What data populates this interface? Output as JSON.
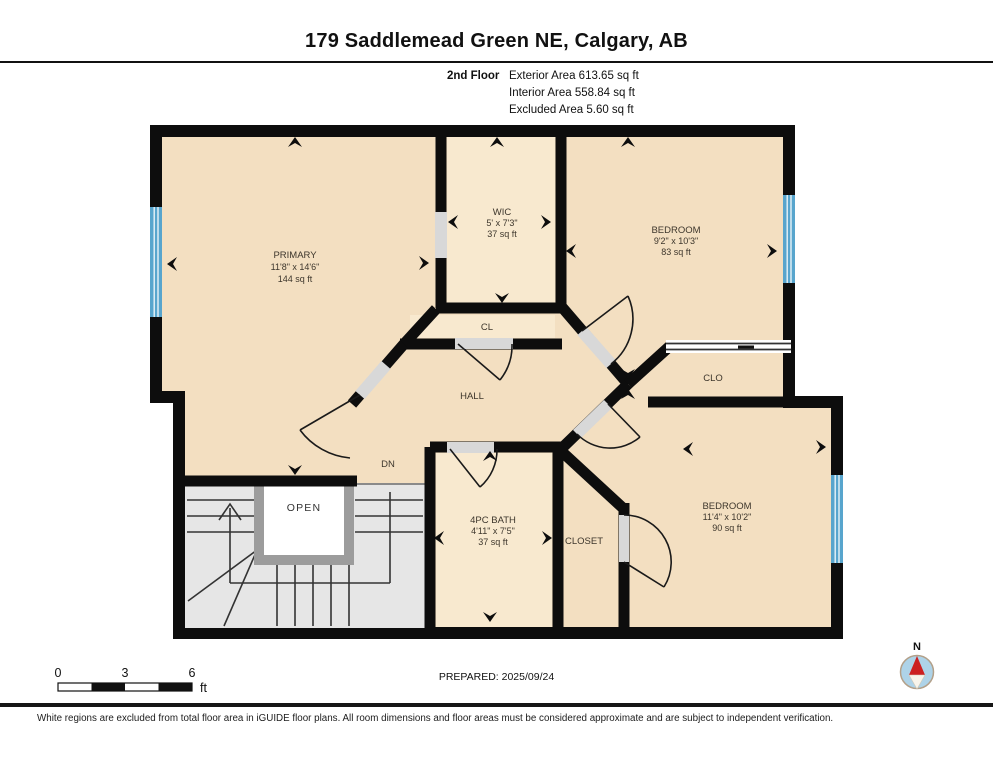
{
  "title": "179 Saddlemead Green NE, Calgary, AB",
  "floor_info": {
    "floor": "2nd Floor",
    "exterior": "Exterior Area 613.65 sq ft",
    "interior": "Interior Area 558.84 sq ft",
    "excluded": "Excluded Area 5.60 sq ft"
  },
  "rooms": {
    "primary": {
      "name": "PRIMARY",
      "dims": "11'8\" x 14'6\"",
      "area": "144 sq ft"
    },
    "wic": {
      "name": "WIC",
      "dims": "5' x 7'3\"",
      "area": "37 sq ft"
    },
    "bedroom1": {
      "name": "BEDROOM",
      "dims": "9'2\" x 10'3\"",
      "area": "83 sq ft"
    },
    "bedroom2": {
      "name": "BEDROOM",
      "dims": "11'4\" x 10'2\"",
      "area": "90 sq ft"
    },
    "bath": {
      "name": "4PC BATH",
      "dims": "4'11\" x 7'5\"",
      "area": "37 sq ft"
    },
    "hall": {
      "name": "HALL"
    },
    "cl": {
      "name": "CL"
    },
    "clo": {
      "name": "CLO"
    },
    "closet": {
      "name": "CLOSET"
    },
    "open": {
      "name": "OPEN"
    },
    "dn": {
      "name": "DN"
    }
  },
  "scale": {
    "t0": "0",
    "t3": "3",
    "t6": "6",
    "unit": "ft"
  },
  "prepared": "PREPARED: 2025/09/24",
  "compass": {
    "n": "N"
  },
  "disclaimer": "White regions are excluded from total floor area in iGUIDE floor plans. All room dimensions and floor areas must be considered approximate and are subject to independent verification.",
  "colors": {
    "floor": "#f3dfc1",
    "wall": "#0d0d0d",
    "window": "#58a5cd",
    "stairs": "#e6e6e6",
    "door_opening": "#d8d8d8",
    "open_frame": "#9c9c9c",
    "compass_fill": "#aed3e8",
    "compass_needle": "#cc2020"
  }
}
